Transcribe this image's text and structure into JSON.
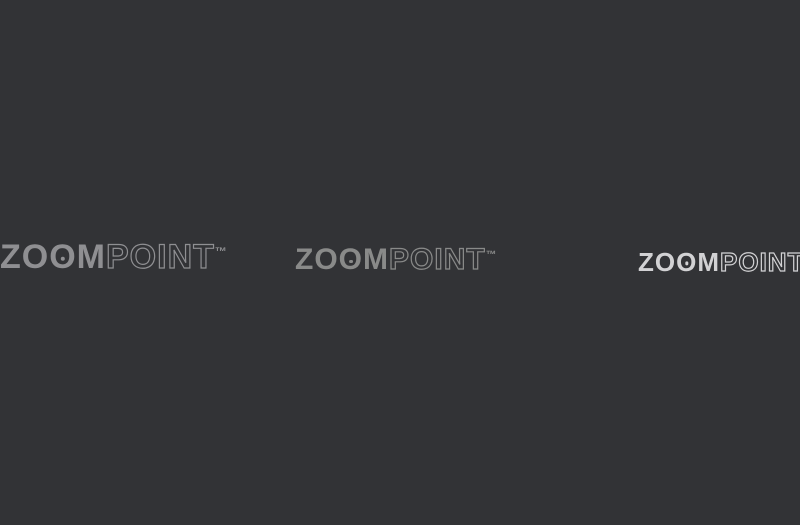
{
  "meta": {
    "content_type": "3d-isometric-floor-plan-render",
    "units_visible": false
  },
  "watermarks": {
    "full_text": "ZOOMPOINT",
    "brand_zo": "ZO",
    "brand_o": "O",
    "brand_m": "M",
    "brand_point": "POINT",
    "trademark": "™",
    "instances": [
      {
        "position": "left"
      },
      {
        "position": "center"
      },
      {
        "position": "right"
      }
    ]
  },
  "colors": {
    "background": "#323336",
    "shadow": "rgba(14,14,16,0.45)",
    "wall_white": "#f2efe9",
    "wall_top": "#988f93",
    "accent_wall": "#8d8084",
    "foyer_wall": "#d8cec0",
    "floor_main": "#e8e0d2",
    "floor_living": "#e4dbc9",
    "floor_bed": "#e6ddcb",
    "floor_bath": "#ddd6c9",
    "floor_shower": "#c8c2ba",
    "floor_bath_blue": "#4a6da5",
    "wood_deck": "#b5895b",
    "wood_counter": "#5f4026",
    "island_top": "#4f3620",
    "wood_furniture": "#a9713d",
    "wood_bedframe": "#b5824e",
    "cabinet_white": "#ece7df",
    "sofa": "#d6b286",
    "cushion": "#dcc3a0",
    "pillow_accent_1": "#6c5b8e",
    "pillow_accent_2": "#8a79a8",
    "duvet_master": "#c79b94",
    "duvet_bed2": "#b7b1a7",
    "duvet_bed3": "#a07c5c",
    "linen_white": "#f4efe4",
    "chair_red": "#d25340",
    "dining_chair": "#d9a77a",
    "table_top": "#9aa0a4",
    "vanity_blue": "#3b5f96",
    "laptop_blue": "#3a6ab0",
    "plant_pot": "#8a8178",
    "greens": [
      "#3e7c3e",
      "#4f9148",
      "#2f6b34",
      "#5aa052"
    ],
    "railing": "#4b3a2f",
    "glass": "rgba(168,196,206,0.38)",
    "white_goods": "#f0eeea",
    "door_wood": "#8a5a33",
    "art_frame": "#33302e",
    "art_1": "#c0603a",
    "art_2": "#aa4a3a",
    "food_yellow": "#e8b93a",
    "clothes": [
      "#b03a3a",
      "#3a4d8a",
      "#e0ddd6",
      "#7a3a7a",
      "#b8812f",
      "#2f6b5a",
      "#993a2a",
      "#d6cfc6"
    ],
    "bottles": [
      "#cc4433",
      "#2f8a4d",
      "#e0a020",
      "#d7d7d7",
      "#8a5aa0"
    ],
    "watermark_left": "#8f8f92",
    "watermark_center": "rgba(245,245,240,0.45)",
    "watermark_right": "#d2d2d4"
  },
  "scene": {
    "rooms": [
      {
        "name": "foyer",
        "features": [
          "entrance-door",
          "circular-wall-decor",
          "cove-lighting"
        ]
      },
      {
        "name": "kitchen",
        "features": [
          "l-shaped-counter",
          "island",
          "open-wall-shelves",
          "microwave",
          "sink"
        ]
      },
      {
        "name": "utility-nook",
        "features": [
          "washing-machine",
          "wall-shelf"
        ]
      },
      {
        "name": "living-room",
        "features": [
          "three-seat-sofa",
          "purple-pillows",
          "round-coffee-table",
          "two-wood-armchairs",
          "accent-armchair",
          "floor-lamp",
          "two-paintings",
          "rug",
          "potted-plants",
          "ottoman"
        ]
      },
      {
        "name": "dining-area",
        "features": [
          "six-seat-table",
          "set-plates",
          "bench",
          "upholstered-chairs"
        ]
      },
      {
        "name": "common-bathroom",
        "features": [
          "blue-top-vanity",
          "vessel-sink",
          "glass-shower",
          "toilet",
          "mirror"
        ]
      },
      {
        "name": "master-bedroom",
        "features": [
          "double-bed-mauve",
          "wardrobe-open",
          "nightstands",
          "foot-bench",
          "rug",
          "plant"
        ]
      },
      {
        "name": "master-bathroom",
        "features": [
          "blue-counter",
          "vessel-sink",
          "glass-shower",
          "towel"
        ]
      },
      {
        "name": "bedroom-2",
        "features": [
          "double-bed-gray",
          "wardrobe-open",
          "dresser-with-mirror",
          "nightstand-lamps",
          "rug"
        ]
      },
      {
        "name": "bedroom-3",
        "features": [
          "double-bed-brown",
          "wardrobe-open",
          "desk-with-laptop",
          "chair",
          "rug"
        ]
      },
      {
        "name": "bathroom-3",
        "features": [
          "blue-floor",
          "vessel-sink",
          "glass-shower",
          "towel"
        ]
      },
      {
        "name": "living-balcony",
        "features": [
          "wood-deck",
          "iron-railing",
          "two-red-chairs",
          "plants",
          "glass-sliding-doors"
        ]
      },
      {
        "name": "bedroom-balcony",
        "features": [
          "wood-deck",
          "iron-railing",
          "banana-plant"
        ]
      }
    ]
  }
}
